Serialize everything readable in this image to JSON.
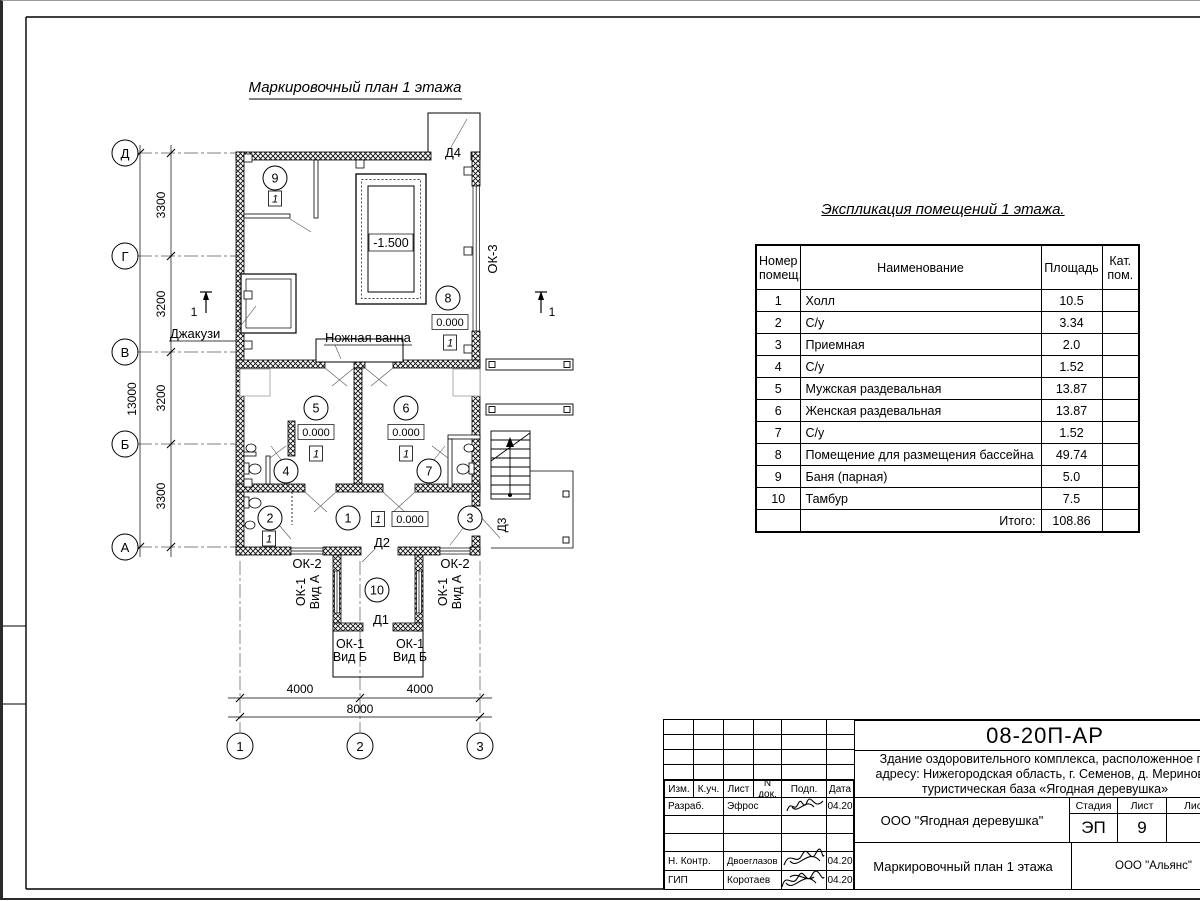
{
  "plan": {
    "title": "Маркировочный план 1 этажа",
    "section_mark": "1",
    "axes": {
      "rows": [
        "Д",
        "Г",
        "В",
        "Б",
        "А"
      ],
      "cols": [
        "1",
        "2",
        "3"
      ]
    },
    "dims": {
      "left_segments": [
        "3300",
        "3200",
        "3200",
        "3300"
      ],
      "left_total": "13000",
      "bottom_segments": [
        "4000",
        "4000"
      ],
      "bottom_total": "8000"
    },
    "rooms": [
      "1",
      "2",
      "3",
      "4",
      "5",
      "6",
      "7",
      "8",
      "9",
      "10"
    ],
    "labels": {
      "jacuzzi": "Джакузи",
      "foot_bath": "Ножная ванна",
      "d1": "Д1",
      "d2": "Д2",
      "d3": "Д3",
      "d4": "Д4",
      "ok3": "ОК-3",
      "ok2": "ОК-2",
      "ok1": "ОК-1",
      "vid_a": "Вид А",
      "vid_b": "Вид Б",
      "zero_level": "0.000",
      "pool_level": "-1.500",
      "finish_marker": "1"
    }
  },
  "explication": {
    "title": "Экспликация помещений 1 этажа.",
    "headers": {
      "num": "Номер помещ.",
      "name": "Наименование",
      "area": "Площадь",
      "cat": "Кат. пом."
    },
    "rows": [
      {
        "num": "1",
        "name": "Холл",
        "area": "10.5"
      },
      {
        "num": "2",
        "name": "С/у",
        "area": "3.34"
      },
      {
        "num": "3",
        "name": "Приемная",
        "area": "2.0"
      },
      {
        "num": "4",
        "name": "С/у",
        "area": "1.52"
      },
      {
        "num": "5",
        "name": "Мужская раздевальная",
        "area": "13.87"
      },
      {
        "num": "6",
        "name": "Женская раздевальная",
        "area": "13.87"
      },
      {
        "num": "7",
        "name": "С/у",
        "area": "1.52"
      },
      {
        "num": "8",
        "name": "Помещение для размещения бассейна",
        "area": "49.74"
      },
      {
        "num": "9",
        "name": "Баня (парная)",
        "area": "5.0"
      },
      {
        "num": "10",
        "name": "Тамбур",
        "area": "7.5"
      }
    ],
    "total_label": "Итого:",
    "total_value": "108.86"
  },
  "titleblock": {
    "doc_number": "08-20П-АР",
    "object_line1": "Здание оздоровительного комплекса, расположенное по",
    "object_line2": "адресу: Нижегородская область, г. Семенов, д. Мериново,",
    "object_line3": "туристическая база «Ягодная деревушка»",
    "org": "ООО \"Ягодная деревушка\"",
    "sheet_title": "Маркировочный план 1 этажа",
    "contractor": "ООО \"Альянс\"",
    "stage_label": "Стадия",
    "sheet_label": "Лист",
    "sheets_label": "Листов",
    "stage": "ЭП",
    "sheet_num": "9",
    "cols": [
      "Изм.",
      "К.уч.",
      "Лист",
      "N док.",
      "Подп.",
      "Дата"
    ],
    "rows": [
      {
        "role": "Разраб.",
        "name": "Эфрос",
        "date": "04.20"
      },
      {
        "role": "",
        "name": "",
        "date": ""
      },
      {
        "role": "",
        "name": "",
        "date": ""
      },
      {
        "role": "Н. Контр.",
        "name": "Двоеглазов",
        "date": "04.20"
      },
      {
        "role": "ГИП",
        "name": "Коротаев",
        "date": "04.20"
      }
    ]
  }
}
